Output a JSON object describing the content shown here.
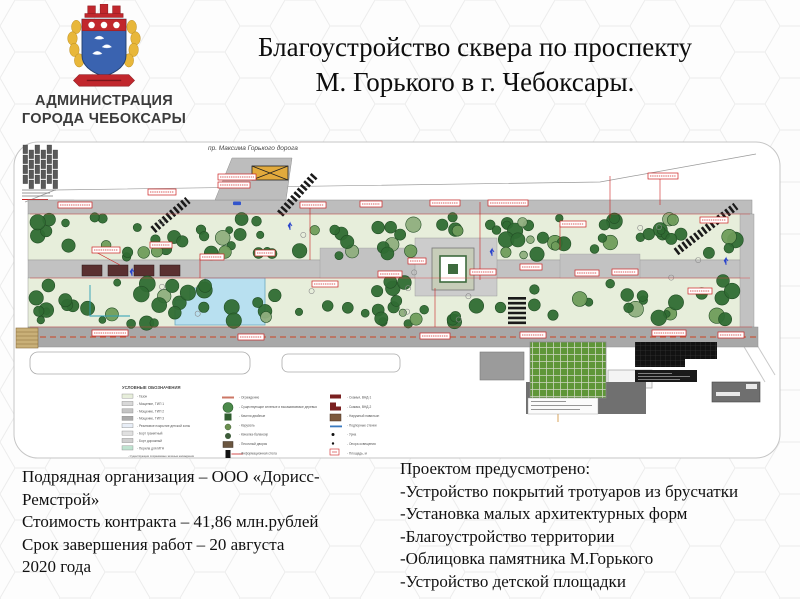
{
  "header": {
    "org_line1": "АДМИНИСТРАЦИЯ",
    "org_line2": "ГОРОДА ЧЕБОКСАРЫ",
    "title_line1": "Благоустройство сквера по проспекту",
    "title_line2": "М. Горького в г. Чебоксары."
  },
  "plan": {
    "road_label": "пр. Максима Горького дорога",
    "legend": {
      "title": "УСЛОВНЫЕ ОБОЗНАЧЕНИЯ",
      "col1": [
        "Газон",
        "Мощение, ТИП 1",
        "Мощение, ТИП 2",
        "Мощение, ТИП 3",
        "Резиновое покрытие детской зоны",
        "Борт гранитный",
        "Борт дорожный",
        "Перила для МГН"
      ],
      "col1_footnote": "Существующие сохраняемые зеленые насаждения",
      "col2": [
        "Ограждение",
        "Существующие зеленые и высаживаемые деревья",
        "Качели двойные",
        "Карусель",
        "Качалка-балансир",
        "Песочный дворик",
        "Информационная стела"
      ],
      "col3": [
        "Скамья, ВНД-1",
        "Скамья, ВНД-2",
        "Наружный павильон",
        "Подпорные стенки",
        "Урна",
        "Опора освещения",
        "Площадь, м"
      ]
    }
  },
  "contract": {
    "lines": [
      "Подрядная организация – ООО «Дорисс-",
      "Ремстрой»",
      "Стоимость контракта – 41,86 млн.рублей",
      "Срок завершения работ – 20 августа",
      "2020 года"
    ]
  },
  "scope": {
    "title": "Проектом предусмотрено:",
    "items": [
      "-Устройство покрытий тротуаров из брусчатки",
      "-Установка малых архитектурных форм",
      "-Благоустройство территории",
      "-Облицовка памятника М.Горького",
      "-Устройство детской площадки"
    ]
  },
  "colors": {
    "lawn": "#e7eedb",
    "path_gray": "#bfbfbf",
    "road_gray": "#a8a8a8",
    "pond_blue": "#b8e0f0",
    "tree_green": "#2f6b33",
    "annotation_red": "#cc2222",
    "emblem_red": "#c1272d",
    "emblem_blue": "#3a63b0",
    "emblem_gold": "#e8b73a"
  }
}
